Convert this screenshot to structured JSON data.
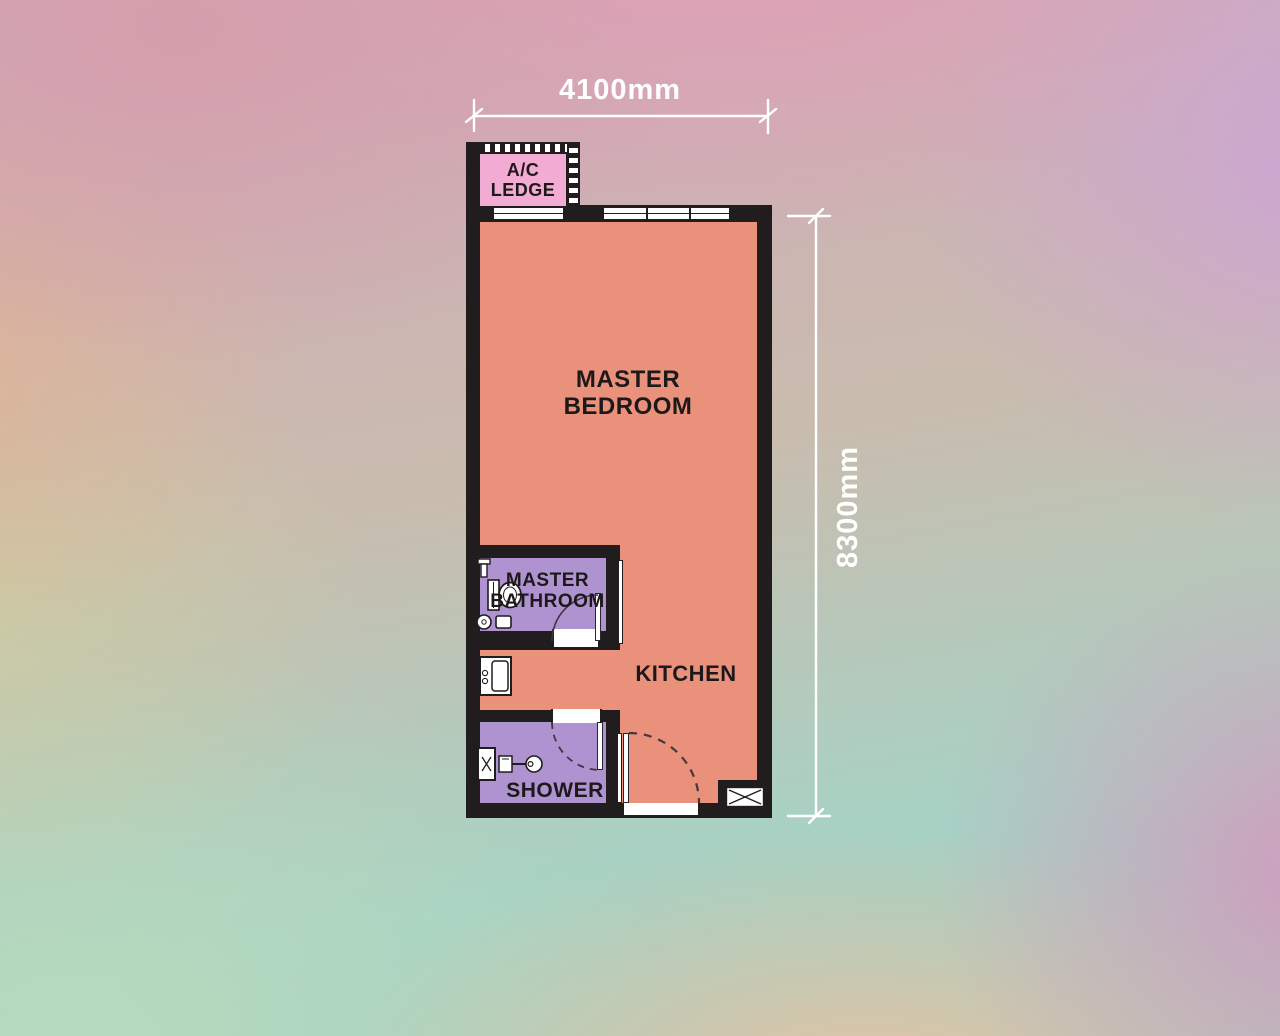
{
  "plan": {
    "title": "studio-unit-floor-plan",
    "dimensions": {
      "width_label": "4100mm",
      "height_label": "8300mm"
    },
    "labels": {
      "ac_ledge": "A/C LEDGE",
      "master_bedroom": "MASTER BEDROOM",
      "master_bathroom": "MASTER BATHROOM",
      "kitchen": "KITCHEN",
      "shower": "SHOWER"
    },
    "colors": {
      "wall": "#211d1e",
      "bedroom_kitchen_floor": "#e9917a",
      "bathroom_shower_floor": "#af92d0",
      "ac_ledge_fill": "#f2abd2",
      "dimension_text": "#ffffff",
      "label_text": "#1d191a"
    }
  }
}
